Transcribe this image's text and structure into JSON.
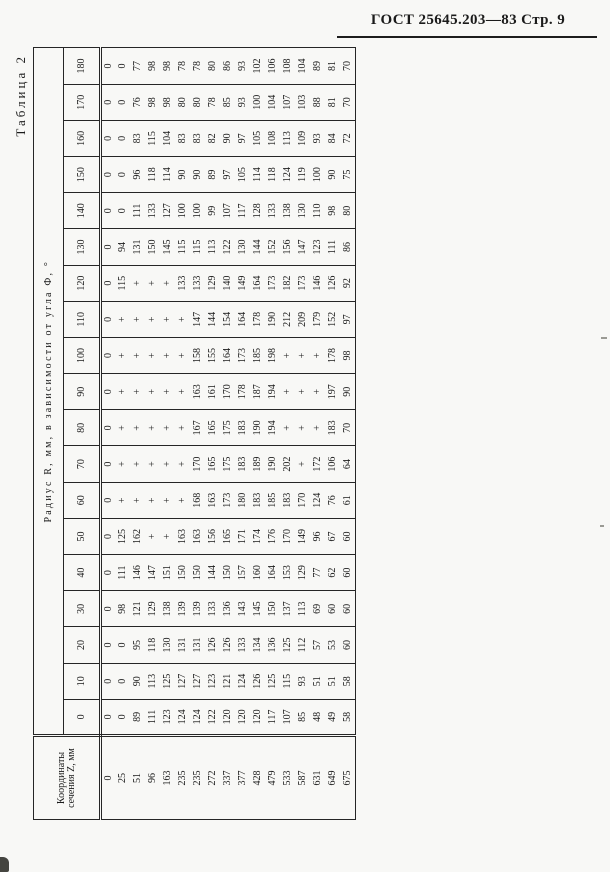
{
  "page": {
    "doc_header": "ГОСТ 25645.203—83 Стр. 9",
    "table_caption": "Таблица 2"
  },
  "table": {
    "stub_header_line1": "Координаты",
    "stub_header_line2": "сечения Z, мм",
    "span_header": "Радиус R, мм, в зависимости от угла Ф, °",
    "angle_labels": [
      "0",
      "10",
      "20",
      "30",
      "40",
      "50",
      "60",
      "70",
      "80",
      "90",
      "100",
      "110",
      "120",
      "130",
      "140",
      "150",
      "160",
      "170",
      "180"
    ],
    "rows": [
      {
        "z": "0",
        "r": [
          "0",
          "0",
          "0",
          "0",
          "0",
          "0",
          "0",
          "0",
          "0",
          "0",
          "0",
          "0",
          "0",
          "0",
          "0",
          "0",
          "0",
          "0",
          "0"
        ]
      },
      {
        "z": "25",
        "r": [
          "0",
          "0",
          "0",
          "98",
          "111",
          "125",
          "+",
          "+",
          "+",
          "+",
          "+",
          "+",
          "115",
          "94",
          "0",
          "0",
          "0",
          "0",
          "0"
        ]
      },
      {
        "z": "51",
        "r": [
          "89",
          "90",
          "95",
          "121",
          "146",
          "162",
          "+",
          "+",
          "+",
          "+",
          "+",
          "+",
          "+",
          "131",
          "111",
          "96",
          "83",
          "76",
          "77"
        ]
      },
      {
        "z": "96",
        "r": [
          "111",
          "113",
          "118",
          "129",
          "147",
          "+",
          "+",
          "+",
          "+",
          "+",
          "+",
          "+",
          "+",
          "150",
          "133",
          "118",
          "115",
          "98",
          "98"
        ]
      },
      {
        "z": "163",
        "r": [
          "123",
          "125",
          "130",
          "138",
          "151",
          "+",
          "+",
          "+",
          "+",
          "+",
          "+",
          "+",
          "+",
          "145",
          "127",
          "114",
          "104",
          "98",
          "98"
        ]
      },
      {
        "z": "235",
        "r": [
          "124",
          "127",
          "131",
          "139",
          "150",
          "163",
          "+",
          "+",
          "+",
          "+",
          "+",
          "+",
          "133",
          "115",
          "100",
          "90",
          "83",
          "80",
          "78"
        ]
      },
      {
        "z": "235",
        "r": [
          "124",
          "127",
          "131",
          "139",
          "150",
          "163",
          "168",
          "170",
          "167",
          "163",
          "158",
          "147",
          "133",
          "115",
          "100",
          "90",
          "83",
          "80",
          "78"
        ]
      },
      {
        "z": "272",
        "r": [
          "122",
          "123",
          "126",
          "133",
          "144",
          "156",
          "163",
          "165",
          "165",
          "161",
          "155",
          "144",
          "129",
          "113",
          "99",
          "89",
          "82",
          "78",
          "80"
        ]
      },
      {
        "z": "337",
        "r": [
          "120",
          "121",
          "126",
          "136",
          "150",
          "165",
          "173",
          "175",
          "175",
          "170",
          "164",
          "154",
          "140",
          "122",
          "107",
          "97",
          "90",
          "85",
          "86"
        ]
      },
      {
        "z": "377",
        "r": [
          "120",
          "124",
          "133",
          "143",
          "157",
          "171",
          "180",
          "183",
          "183",
          "178",
          "173",
          "164",
          "149",
          "130",
          "117",
          "105",
          "97",
          "93",
          "93"
        ]
      },
      {
        "z": "428",
        "r": [
          "120",
          "126",
          "134",
          "145",
          "160",
          "174",
          "183",
          "189",
          "190",
          "187",
          "185",
          "178",
          "164",
          "144",
          "128",
          "114",
          "105",
          "100",
          "102"
        ]
      },
      {
        "z": "479",
        "r": [
          "117",
          "125",
          "136",
          "150",
          "164",
          "176",
          "185",
          "190",
          "194",
          "194",
          "198",
          "190",
          "173",
          "152",
          "133",
          "118",
          "108",
          "104",
          "106"
        ]
      },
      {
        "z": "533",
        "r": [
          "107",
          "115",
          "125",
          "137",
          "153",
          "170",
          "183",
          "202",
          "+",
          "+",
          "+",
          "212",
          "182",
          "156",
          "138",
          "124",
          "113",
          "107",
          "108"
        ]
      },
      {
        "z": "587",
        "r": [
          "85",
          "93",
          "112",
          "113",
          "129",
          "149",
          "170",
          "+",
          "+",
          "+",
          "+",
          "209",
          "173",
          "147",
          "130",
          "119",
          "109",
          "103",
          "104"
        ]
      },
      {
        "z": "631",
        "r": [
          "48",
          "51",
          "57",
          "69",
          "77",
          "96",
          "124",
          "172",
          "+",
          "+",
          "+",
          "179",
          "146",
          "123",
          "110",
          "100",
          "93",
          "88",
          "89"
        ]
      },
      {
        "z": "649",
        "r": [
          "49",
          "51",
          "53",
          "60",
          "62",
          "67",
          "76",
          "106",
          "183",
          "197",
          "178",
          "152",
          "126",
          "111",
          "98",
          "90",
          "84",
          "81",
          "81"
        ]
      },
      {
        "z": "675",
        "r": [
          "58",
          "58",
          "60",
          "60",
          "60",
          "60",
          "61",
          "64",
          "70",
          "90",
          "98",
          "97",
          "92",
          "86",
          "80",
          "75",
          "72",
          "70",
          "70"
        ]
      }
    ]
  }
}
